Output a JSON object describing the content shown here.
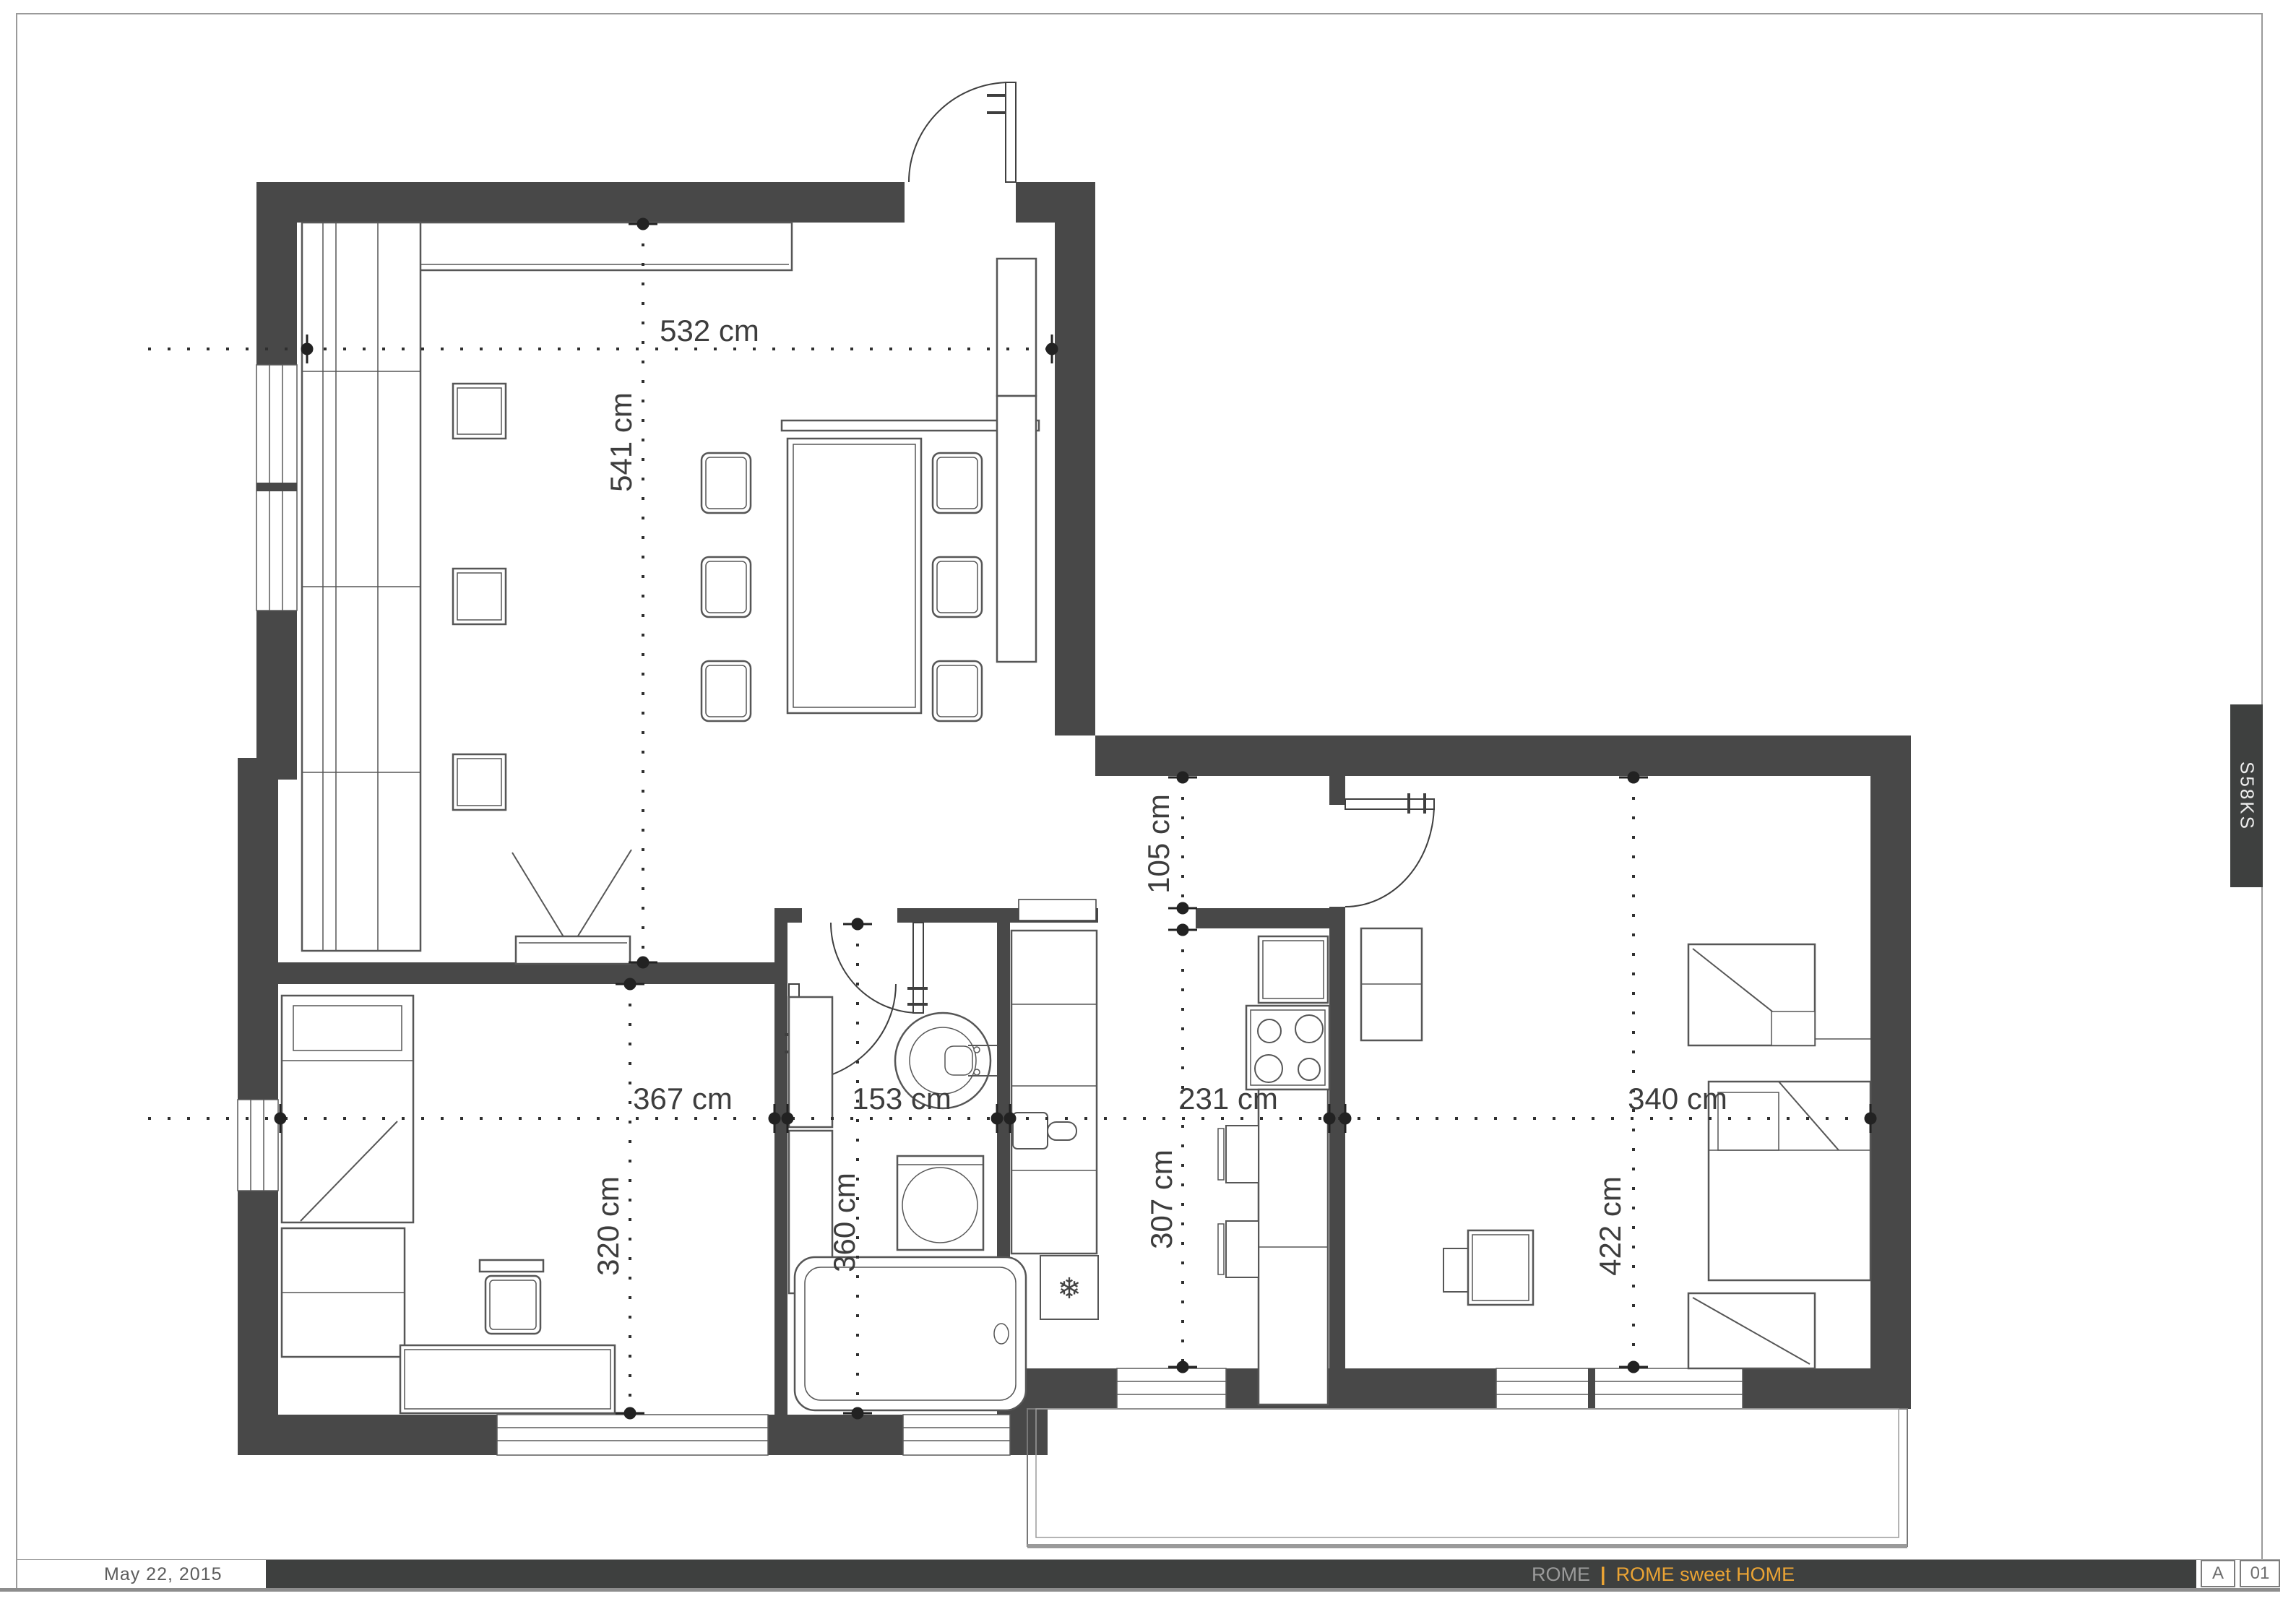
{
  "sheet": {
    "date": "May 22, 2015",
    "brand_gray": "ROME",
    "separator": "|",
    "brand_orange": "ROME sweet HOME",
    "revision": "A",
    "page_number": "01",
    "drawing_code": "S58KS"
  },
  "colors": {
    "accent_orange": "#eba434",
    "wall_dark": "#484848",
    "footer_bar": "#3e403f"
  },
  "icons": {
    "snowflake": "❄"
  },
  "dimensions": {
    "living_width": "532 cm",
    "living_depth": "541 cm",
    "passage_width": "105 cm",
    "bedroom1_width": "367 cm",
    "bedroom1_depth": "320 cm",
    "bathroom_width": "153 cm",
    "bathroom_depth": "360 cm",
    "kitchen_width": "231 cm",
    "kitchen_depth": "307 cm",
    "bedroom2_width": "340 cm",
    "bedroom2_depth": "422 cm"
  }
}
